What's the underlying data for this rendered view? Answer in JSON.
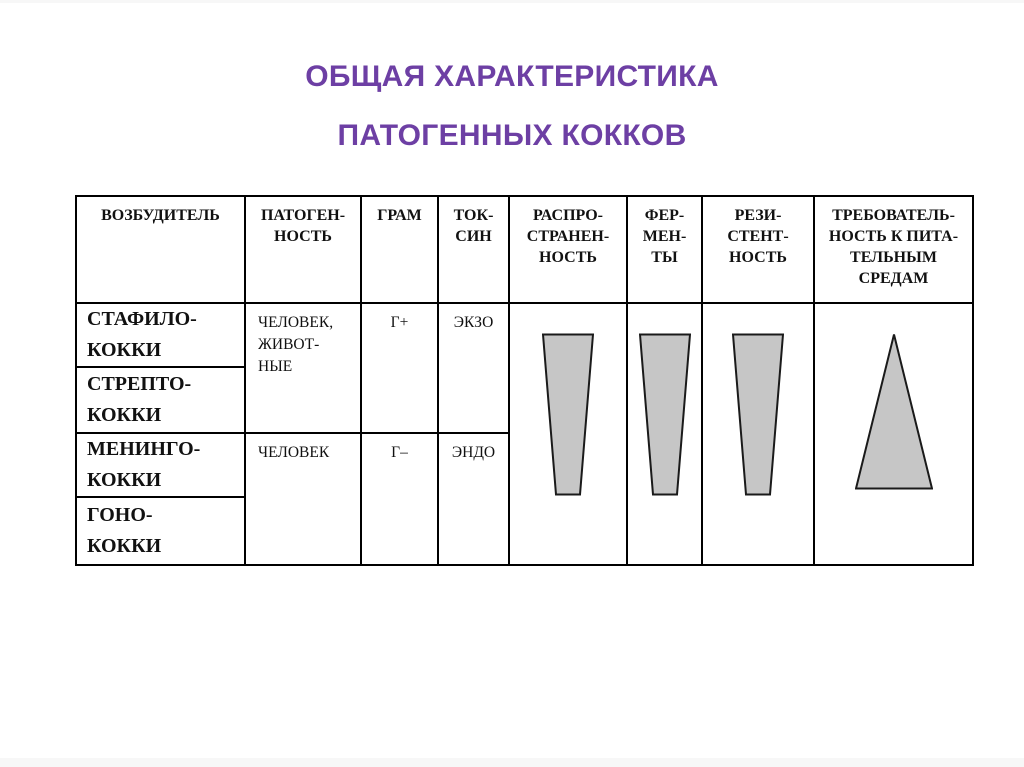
{
  "slide": {
    "title_line1": "ОБЩАЯ ХАРАКТЕРИСТИКА",
    "title_line2": "ПАТОГЕННЫХ КОККОВ",
    "title_color": "#6d3fa4"
  },
  "table": {
    "headers": [
      "ВОЗБУДИТЕЛЬ",
      "ПАТОГЕН-\nНОСТЬ",
      "ГРАМ",
      "ТОК-\nСИН",
      "РАСПРО-\nСТРАНЕН-\nНОСТЬ",
      "ФЕР-\nМЕН-\nТЫ",
      "РЕЗИ-\nСТЕНТ-\nНОСТЬ",
      "ТРЕБОВАТЕЛЬ-\nНОСТЬ К ПИТА-\nТЕЛЬНЫМ\nСРЕДАМ"
    ],
    "row_labels": [
      "СТАФИЛО-\nКОККИ",
      "СТРЕПТО-\nКОККИ",
      "МЕНИНГО-\nКОККИ",
      "ГОНО-\nКОККИ"
    ],
    "groups": [
      {
        "pathogenicity": "ЧЕЛОВЕК,\nЖИВОТ-\nНЫЕ",
        "gram": "Г+",
        "toxin": "ЭКЗО"
      },
      {
        "pathogenicity": "ЧЕЛОВЕК",
        "gram": "Г–",
        "toxin": "ЭНДО"
      }
    ],
    "shapes": {
      "fill": "#c6c6c6",
      "outline": "#1a1a1a",
      "items": [
        {
          "column": "РАСПРОСТРАНЕННОСТЬ",
          "type": "trapezoid-tapering-down"
        },
        {
          "column": "ФЕРМЕНТЫ",
          "type": "trapezoid-tapering-down"
        },
        {
          "column": "РЕЗИСТЕНТНОСТЬ",
          "type": "trapezoid-tapering-down"
        },
        {
          "column": "ТРЕБОВАТЕЛЬНОСТЬ К ПИТАТЕЛЬНЫМ СРЕДАМ",
          "type": "triangle-widening-down"
        }
      ]
    }
  }
}
